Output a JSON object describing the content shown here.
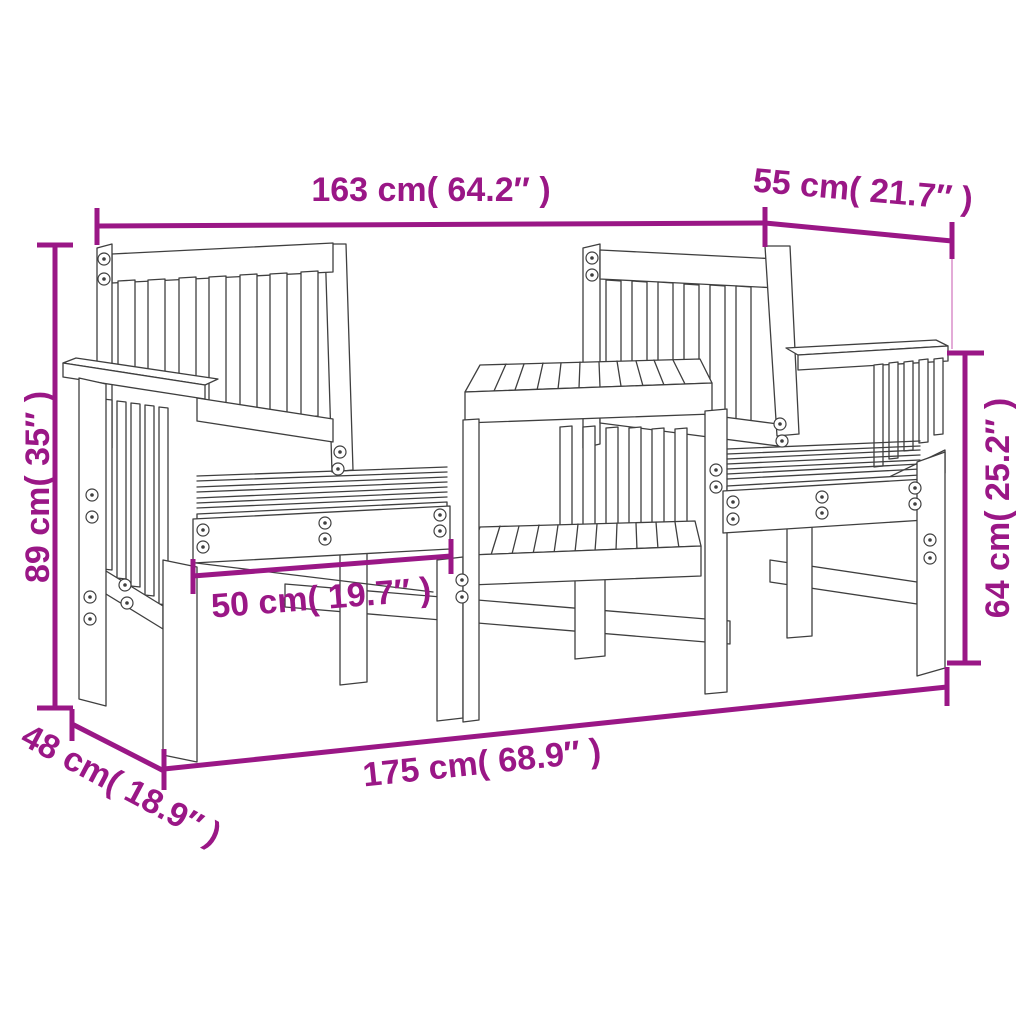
{
  "image": {
    "type": "product-dimension-diagram",
    "subject": "2-seater wooden garden bench with centre table",
    "background_color": "#ffffff",
    "annotation_color": "#9a1786",
    "extension_line_color": "#e3abd7",
    "artwork_line_color": "#3f3f3f"
  },
  "dimensions": {
    "overall_width_top": {
      "label": "163 cm( 64.2″ )"
    },
    "depth_top_right": {
      "label": "55 cm( 21.7″ )"
    },
    "overall_height_left": {
      "label": "89 cm( 35″ )"
    },
    "armrest_height_right": {
      "label": "64 cm( 25.2″ )"
    },
    "seat_width_center": {
      "label": "50 cm( 19.7″ )"
    },
    "overall_width_bottom": {
      "label": "175 cm( 68.9″ )"
    },
    "depth_bottom_left": {
      "label": "48 cm( 18.9″ )"
    }
  }
}
